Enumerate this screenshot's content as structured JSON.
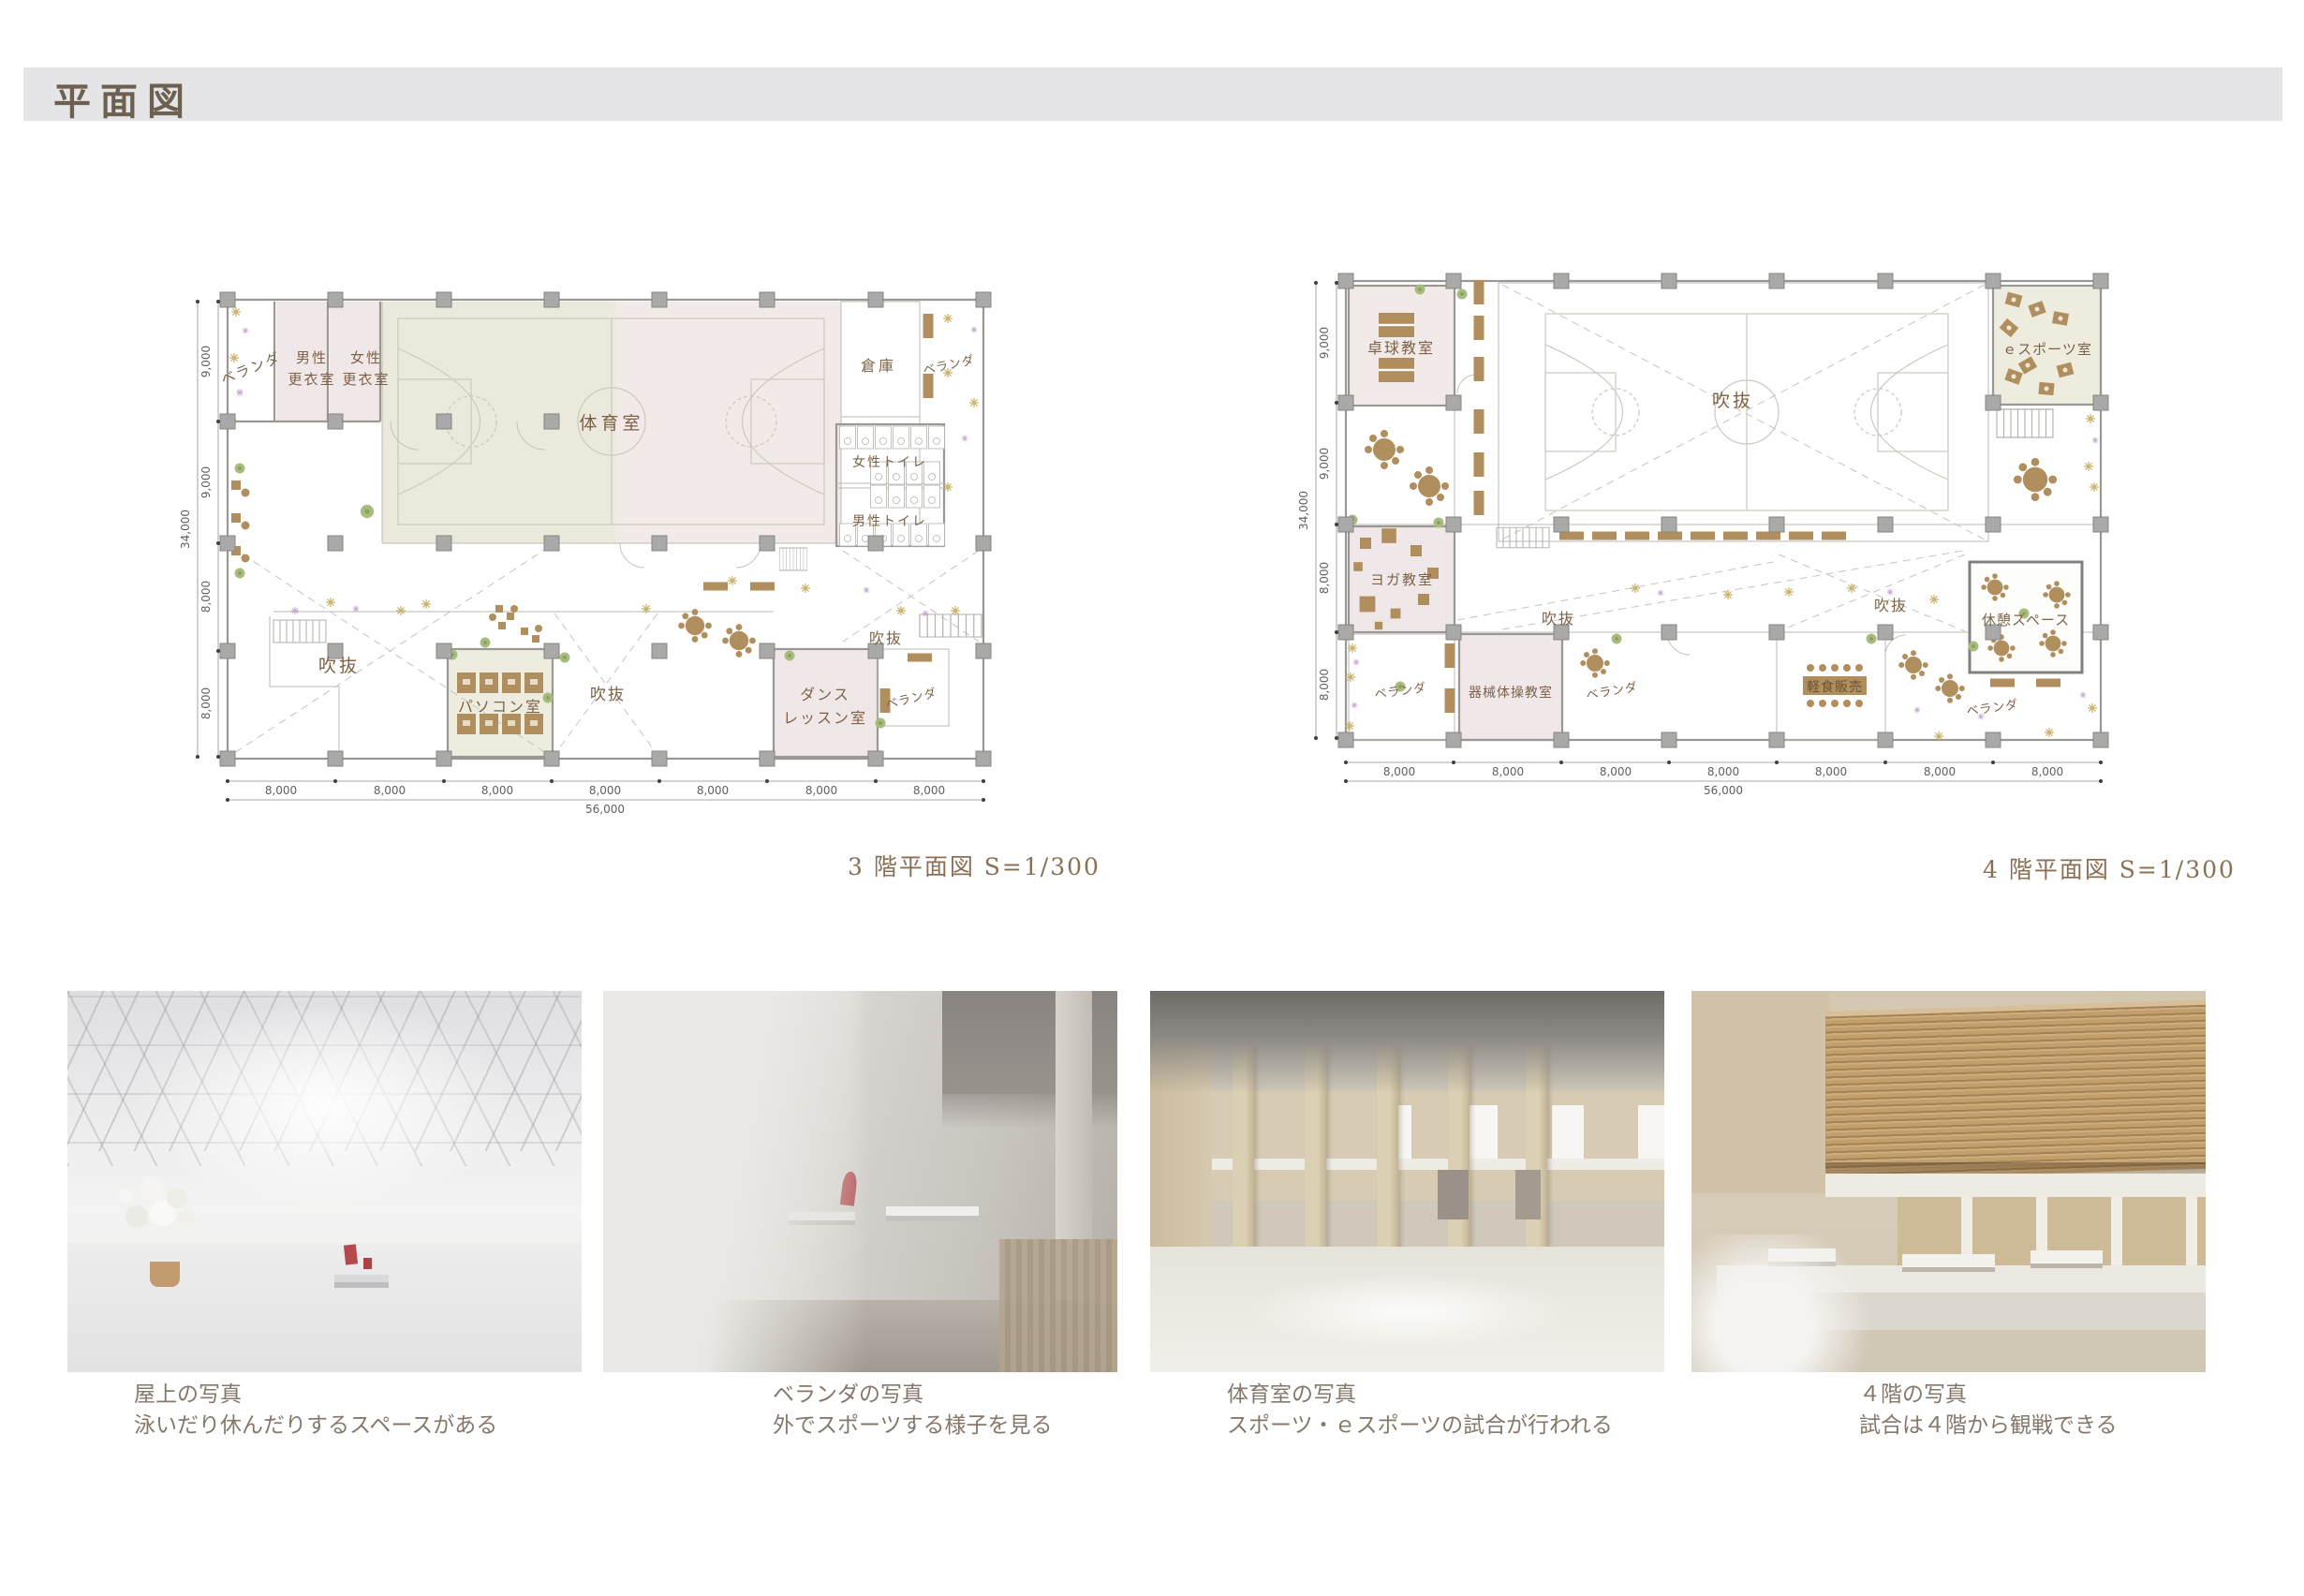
{
  "page": {
    "title": "平面図"
  },
  "plans": {
    "floor3": {
      "caption": "3 階平面図 S=1/300",
      "rooms": {
        "veranda_tl": "ベランダ",
        "mens_locker": [
          "男性",
          "更衣室"
        ],
        "womens_locker": [
          "女性",
          "更衣室"
        ],
        "gym": "体育室",
        "storage": "倉庫",
        "veranda_tr": "ベランダ",
        "womens_toilet": "女性トイレ",
        "mens_toilet": "男性トイレ",
        "void1": "吹抜",
        "void2": "吹抜",
        "void3": "吹抜",
        "pc_room": "パソコン室",
        "dance": [
          "ダンス",
          "レッスン室"
        ],
        "veranda_br": "ベランダ"
      },
      "dims": {
        "v": [
          "9,000",
          "9,000",
          "8,000",
          "8,000"
        ],
        "v_total": "34,000",
        "h": [
          "8,000",
          "8,000",
          "8,000",
          "8,000",
          "8,000",
          "8,000",
          "8,000"
        ],
        "h_total": "56,000"
      }
    },
    "floor4": {
      "caption": "4 階平面図 S=1/300",
      "rooms": {
        "table_tennis": "卓球教室",
        "void_gym": "吹抜",
        "esports": "ｅスポーツ室",
        "yoga": "ヨガ教室",
        "veranda_bl": "ベランダ",
        "gymnastics": "器械体操教室",
        "void_mid": "吹抜",
        "veranda_mid": "ベランダ",
        "void_right": "吹抜",
        "rest_space": "休憩スペース",
        "snack": "軽食販売",
        "veranda_br": "ベランダ"
      },
      "dims": {
        "v": [
          "9,000",
          "9,000",
          "8,000",
          "8,000"
        ],
        "v_total": "34,000",
        "h": [
          "8,000",
          "8,000",
          "8,000",
          "8,000",
          "8,000",
          "8,000",
          "8,000"
        ],
        "h_total": "56,000"
      }
    }
  },
  "photos": [
    {
      "title": "屋上の写真",
      "desc": "泳いだり休んだりするスペースがある"
    },
    {
      "title": "ベランダの写真",
      "desc": "外でスポーツする様子を見る"
    },
    {
      "title": "体育室の写真",
      "desc": "スポーツ・ｅスポーツの試合が行われる"
    },
    {
      "title": "４階の写真",
      "desc": "試合は４階から観戦できる"
    }
  ],
  "colors": {
    "accent_brown": "#7d6247",
    "room_pink": "#f0e8e8",
    "room_beige": "#edecdf",
    "title_bar": "#e5e5e7",
    "furniture": "#b08e5e"
  }
}
